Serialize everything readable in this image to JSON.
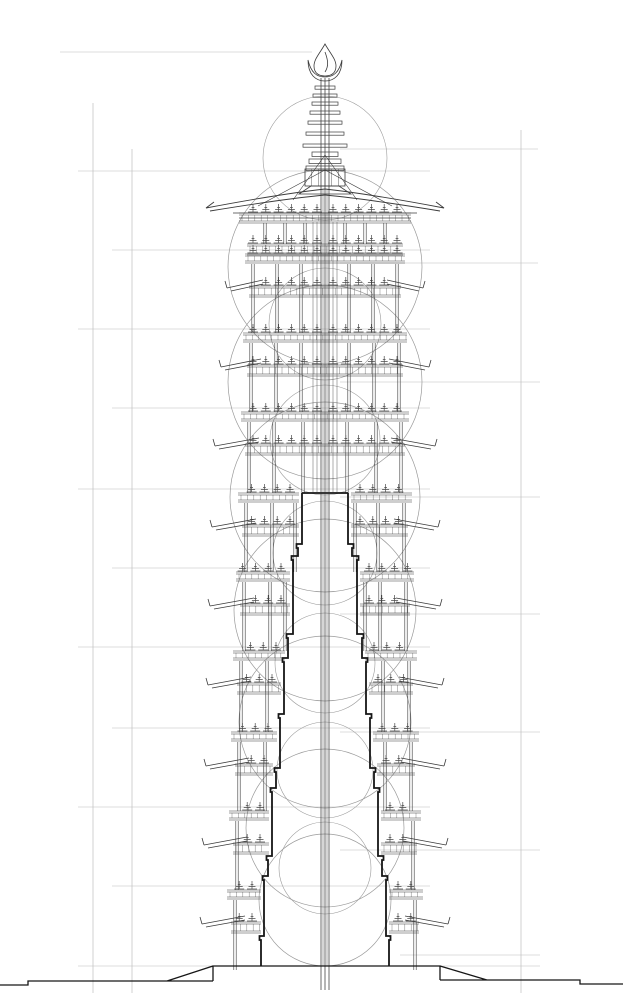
{
  "canvas": {
    "width": 623,
    "height": 1000,
    "background": "#ffffff"
  },
  "colors": {
    "guide": "#bdbdbd",
    "construction_circle": "#9a9a9a",
    "structure": "#3b3b3b",
    "detail": "#4a4a4a",
    "core_outline": "#161616",
    "background": "#ffffff"
  },
  "axis_x": 325,
  "guides": {
    "verticals": [
      {
        "x": 93,
        "y1": 103,
        "y2": 993
      },
      {
        "x": 132,
        "y1": 149,
        "y2": 993
      },
      {
        "x": 521,
        "y1": 130,
        "y2": 993
      }
    ],
    "horizontals": [
      {
        "y": 52,
        "x1": 60,
        "x2": 312
      },
      {
        "y": 171,
        "x1": 78,
        "x2": 430
      },
      {
        "y": 250,
        "x1": 112,
        "x2": 430
      },
      {
        "y": 329,
        "x1": 78,
        "x2": 430
      },
      {
        "y": 408,
        "x1": 112,
        "x2": 430
      },
      {
        "y": 489,
        "x1": 78,
        "x2": 430
      },
      {
        "y": 568,
        "x1": 112,
        "x2": 430
      },
      {
        "y": 647,
        "x1": 78,
        "x2": 430
      },
      {
        "y": 728,
        "x1": 112,
        "x2": 430
      },
      {
        "y": 807,
        "x1": 78,
        "x2": 430
      },
      {
        "y": 886,
        "x1": 112,
        "x2": 430
      },
      {
        "y": 966,
        "x1": 78,
        "x2": 213
      },
      {
        "y": 149,
        "x1": 340,
        "x2": 538
      },
      {
        "y": 263,
        "x1": 340,
        "x2": 538
      },
      {
        "y": 382,
        "x1": 340,
        "x2": 540
      },
      {
        "y": 497,
        "x1": 340,
        "x2": 540
      },
      {
        "y": 614,
        "x1": 340,
        "x2": 540
      },
      {
        "y": 732,
        "x1": 340,
        "x2": 540
      },
      {
        "y": 850,
        "x1": 340,
        "x2": 540
      },
      {
        "y": 955,
        "x1": 400,
        "x2": 540
      },
      {
        "y": 966,
        "x1": 440,
        "x2": 540
      }
    ]
  },
  "construction_circles": {
    "large": [
      [
        267,
        97
      ],
      [
        382,
        97
      ],
      [
        497,
        95
      ],
      [
        610,
        91
      ],
      [
        722,
        86
      ],
      [
        828,
        79
      ],
      [
        900,
        66
      ]
    ],
    "small": [
      [
        158,
        62
      ],
      [
        324,
        56
      ],
      [
        440,
        55
      ],
      [
        553,
        52
      ],
      [
        663,
        50
      ],
      [
        770,
        48
      ],
      [
        868,
        46
      ]
    ]
  },
  "finial": {
    "flame": {
      "tip_y": 44,
      "base_y": 76,
      "half_width": 11
    },
    "crescent": {
      "horn_y": 60,
      "bowl_y": 81,
      "half_width": 17
    },
    "discs": [
      [
        86,
        10
      ],
      [
        94,
        12
      ],
      [
        102,
        13
      ],
      [
        111,
        15
      ],
      [
        121,
        17
      ],
      [
        132,
        19
      ],
      [
        144,
        22
      ]
    ],
    "pedestal": [
      [
        152,
        13
      ],
      [
        159,
        16
      ],
      [
        166,
        19
      ]
    ],
    "bulb": {
      "y1": 169,
      "y2": 186,
      "half_width": 20,
      "ribs": 5
    },
    "flare": {
      "y1": 186,
      "y2": 194,
      "hw_top": 14,
      "hw_bottom": 26
    }
  },
  "roof": {
    "apex_y": 189,
    "tip_dx": 111,
    "tip_y": 208,
    "kick": 6,
    "beams": [
      [
        213,
        92
      ],
      [
        218,
        86
      ]
    ],
    "struts": [
      [
        170,
        67,
        206
      ],
      [
        155,
        32,
        200
      ]
    ]
  },
  "top_tier": {
    "bands": [
      {
        "y": 213,
        "h": 10,
        "hw": 86
      },
      {
        "y": 244,
        "h": 11,
        "hw": 78
      }
    ],
    "cols": [
      60,
      40,
      20
    ],
    "col_y1": 223,
    "col_y2": 244
  },
  "storeys": [
    {
      "y": 250,
      "w": 72,
      "tip": 98,
      "cols": [
        72,
        48,
        24
      ]
    },
    {
      "y": 329,
      "w": 74,
      "tip": 104,
      "cols": [
        74,
        49,
        24
      ]
    },
    {
      "y": 408,
      "w": 76,
      "tip": 110,
      "cols": [
        76,
        51,
        22
      ]
    },
    {
      "y": 489,
      "w": 79,
      "tip": 113,
      "cols": [
        79,
        53,
        30
      ]
    },
    {
      "y": 568,
      "w": 81,
      "tip": 115,
      "cols": [
        81,
        55,
        40
      ]
    },
    {
      "y": 647,
      "w": 84,
      "tip": 117,
      "cols": [
        84,
        58,
        46
      ]
    },
    {
      "y": 728,
      "w": 86,
      "tip": 119,
      "cols": [
        86,
        60,
        52
      ]
    },
    {
      "y": 807,
      "w": 88,
      "tip": 121,
      "cols": [
        88,
        62,
        58
      ]
    },
    {
      "y": 886,
      "w": 90,
      "tip": 123,
      "cols": [
        90,
        64,
        62
      ]
    }
  ],
  "storey_height": 79,
  "core": {
    "top_y": 493,
    "bottom_y": 966,
    "steps": [
      [
        23,
        493
      ],
      [
        27,
        544
      ],
      [
        32,
        556
      ],
      [
        37,
        634
      ],
      [
        41,
        658
      ],
      [
        45,
        714
      ],
      [
        49,
        768
      ],
      [
        53,
        788
      ],
      [
        57,
        856
      ],
      [
        61,
        876
      ],
      [
        64,
        936
      ]
    ]
  },
  "mast": {
    "outer_offsets": [
      -4,
      0,
      4
    ],
    "outer_y1": 78,
    "outer_y2": 990,
    "inner_offsets": [
      -2,
      2
    ],
    "inner_y1": 190,
    "inner_y2": 966,
    "frame_offsets": [
      -12,
      -8,
      8,
      12
    ],
    "frame_y1": 222,
    "frame_y2": 492
  },
  "base": {
    "platform_top_y": 966,
    "platform_x1": 213,
    "platform_x2": 440,
    "edge_bottom_left_y": 981,
    "edge_bottom_right_y": 980,
    "ramp_left": [
      167,
      981,
      213,
      966
    ],
    "ramp_right": [
      440,
      966,
      487,
      980
    ],
    "ground_left": {
      "y": 981,
      "x1": 28,
      "x2": 213
    },
    "ground_left_outer": {
      "y": 985,
      "x1": 0,
      "x2": 28
    },
    "ground_right": {
      "y": 980,
      "x1": 440,
      "x2": 580
    },
    "ground_right_outer": {
      "y": 984,
      "x1": 580,
      "x2": 623
    }
  }
}
